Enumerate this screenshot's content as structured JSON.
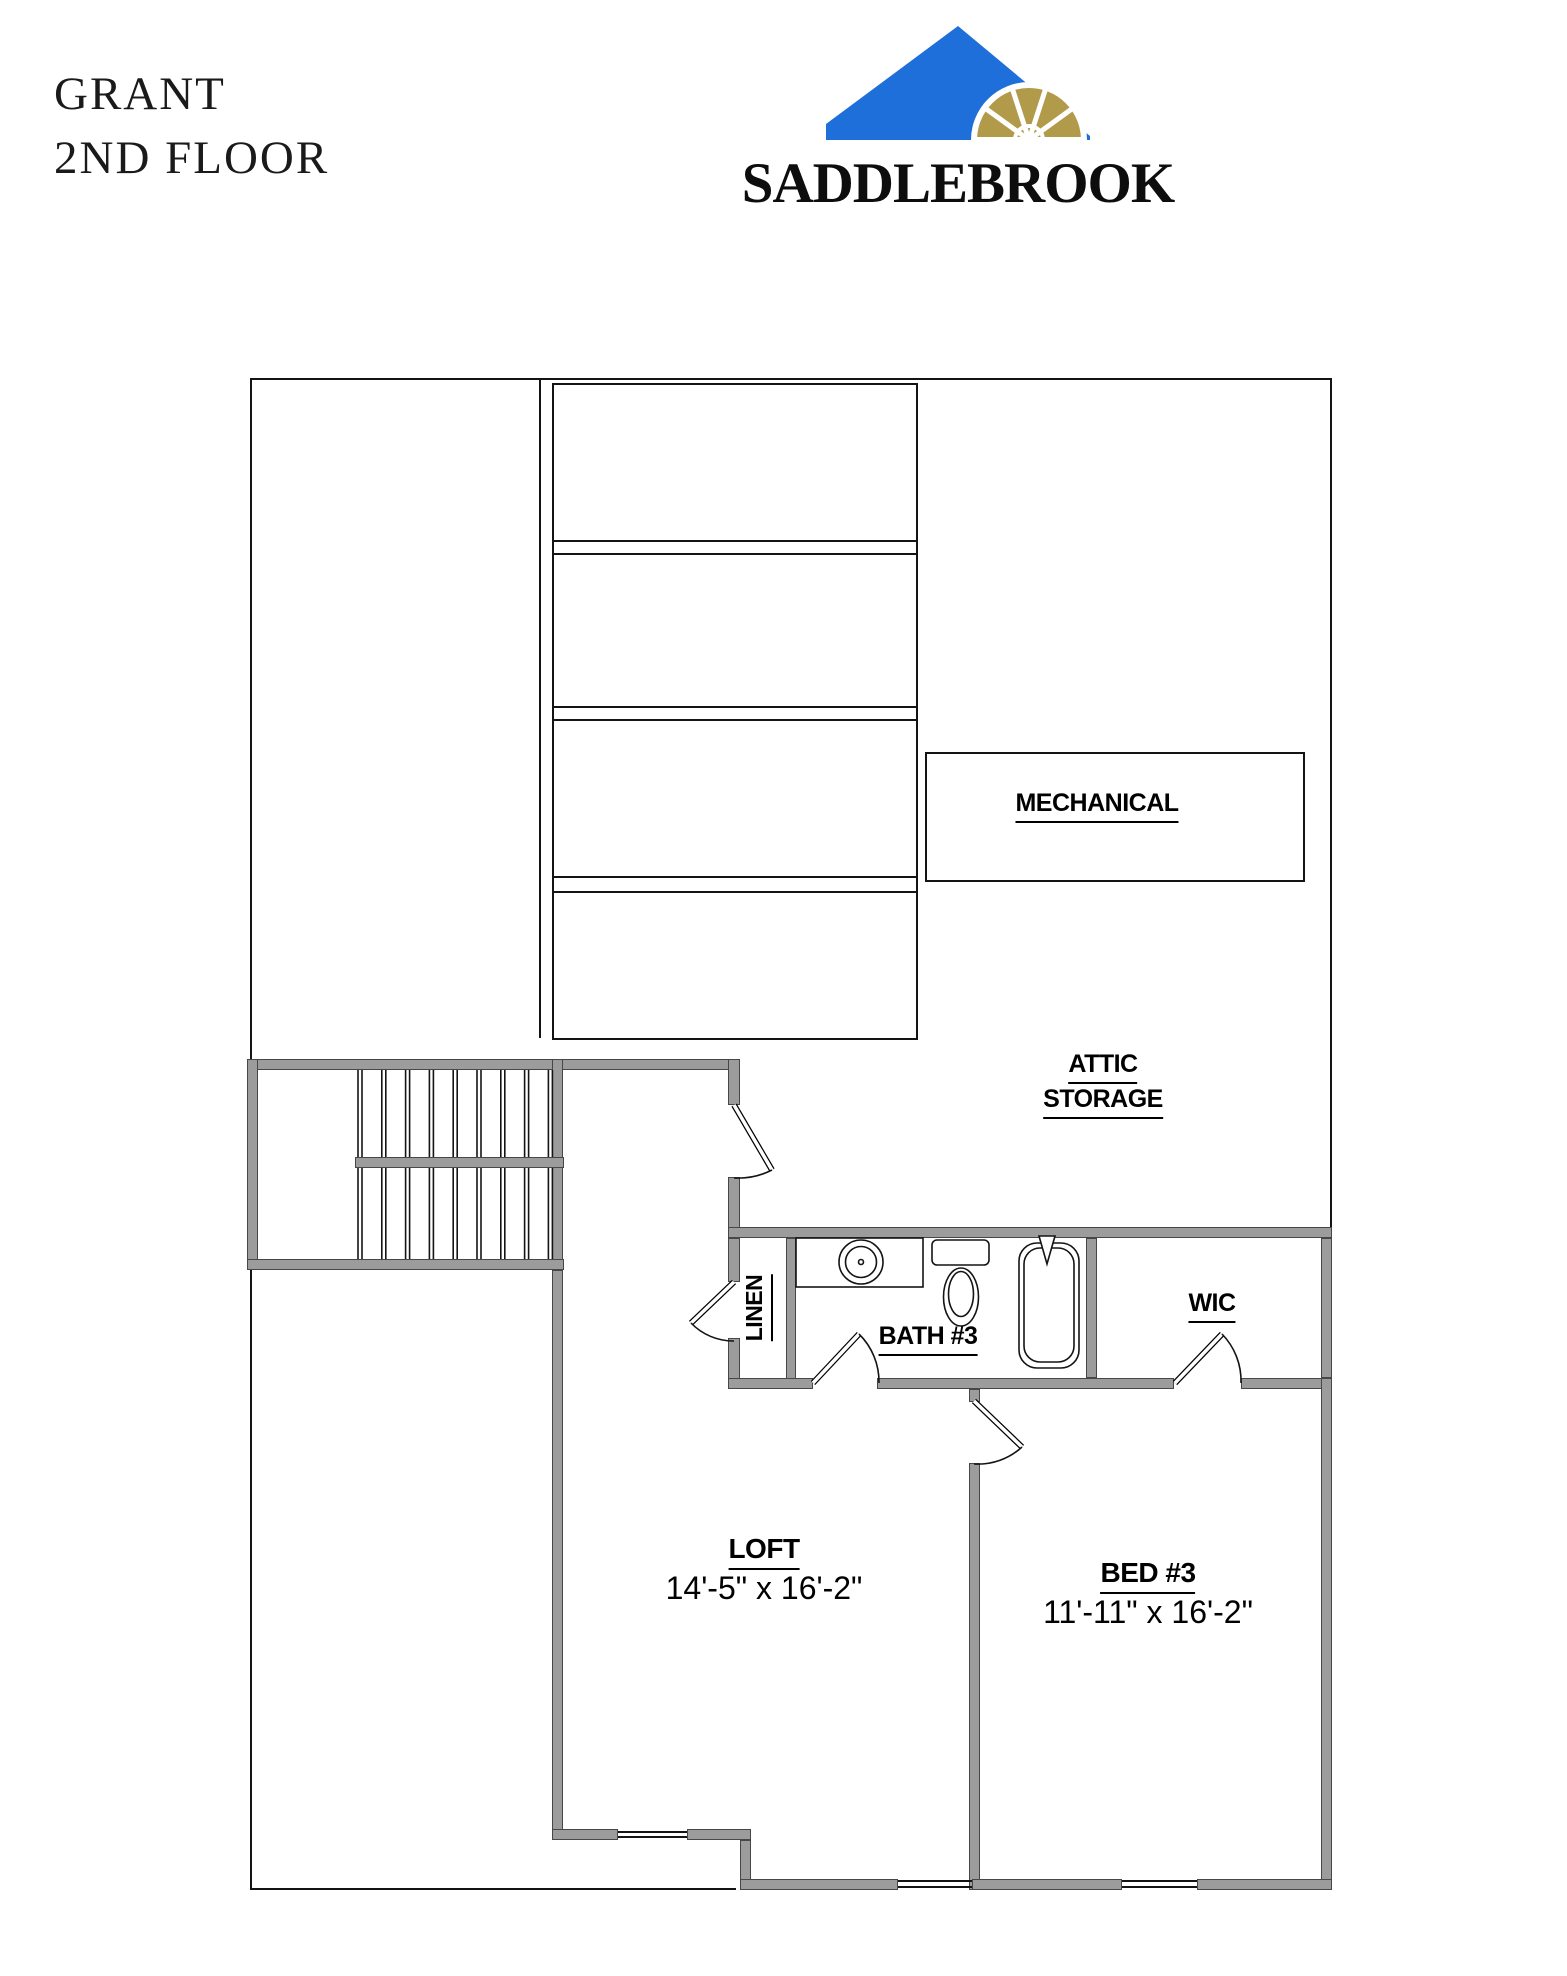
{
  "header": {
    "title_line1": "GRANT",
    "title_line2": "2ND FLOOR",
    "brand": "SADDLEBROOK",
    "colors": {
      "roof_blue": "#1e6fd9",
      "fan_gold": "#b29a4b",
      "line_black": "#141414",
      "wall_gray": "#9c9c9c"
    }
  },
  "plan": {
    "mechanical_label": "MECHANICAL",
    "attic_label_line1": "ATTIC",
    "attic_label_line2": "STORAGE",
    "linen_label": "LINEN",
    "bath_label": "BATH #3",
    "wic_label": "WIC",
    "loft_label": "LOFT",
    "loft_dimensions": "14'-5\" x 16'-2\"",
    "bed3_label": "BED #3",
    "bed3_dimensions": "11'-11\" x 16'-2\""
  }
}
